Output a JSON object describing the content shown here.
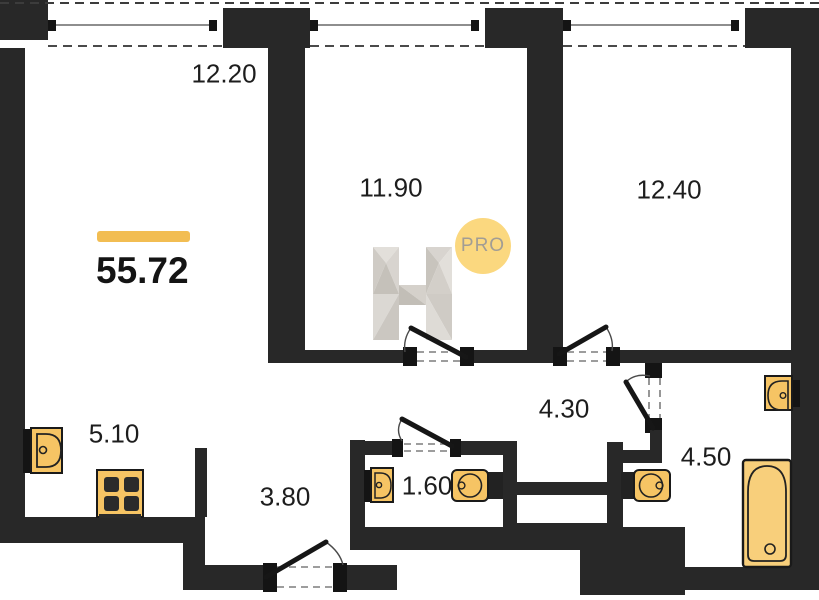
{
  "plan": {
    "type": "apartment-floor-plan",
    "total_area": "55.72",
    "badge": "PRO",
    "rooms": [
      {
        "name": "living-room",
        "area": "12.20"
      },
      {
        "name": "bedroom-middle",
        "area": "11.90"
      },
      {
        "name": "bedroom-right",
        "area": "12.40"
      },
      {
        "name": "kitchen-zone",
        "area": "5.10"
      },
      {
        "name": "entry-hall",
        "area": "3.80"
      },
      {
        "name": "wc",
        "area": "1.60"
      },
      {
        "name": "corridor",
        "area": "4.30"
      },
      {
        "name": "bathroom",
        "area": "4.50"
      }
    ],
    "fixtures": [
      "kitchen-sink",
      "stove",
      "wc-sink",
      "wc-toilet",
      "bathroom-toilet",
      "bathroom-sink",
      "bathtub"
    ],
    "windows_count": 3,
    "doors_count": 5,
    "colors": {
      "wall": "#282828",
      "fixture_fill": "#f6c464",
      "fixture_stroke": "#1a1a1a",
      "accent_bar": "#f2bd52",
      "badge_fill": "#fbd87f",
      "badge_text": "#a29d94",
      "logo_gray": "#d2cec8",
      "label_text": "#1d1d1d"
    }
  }
}
